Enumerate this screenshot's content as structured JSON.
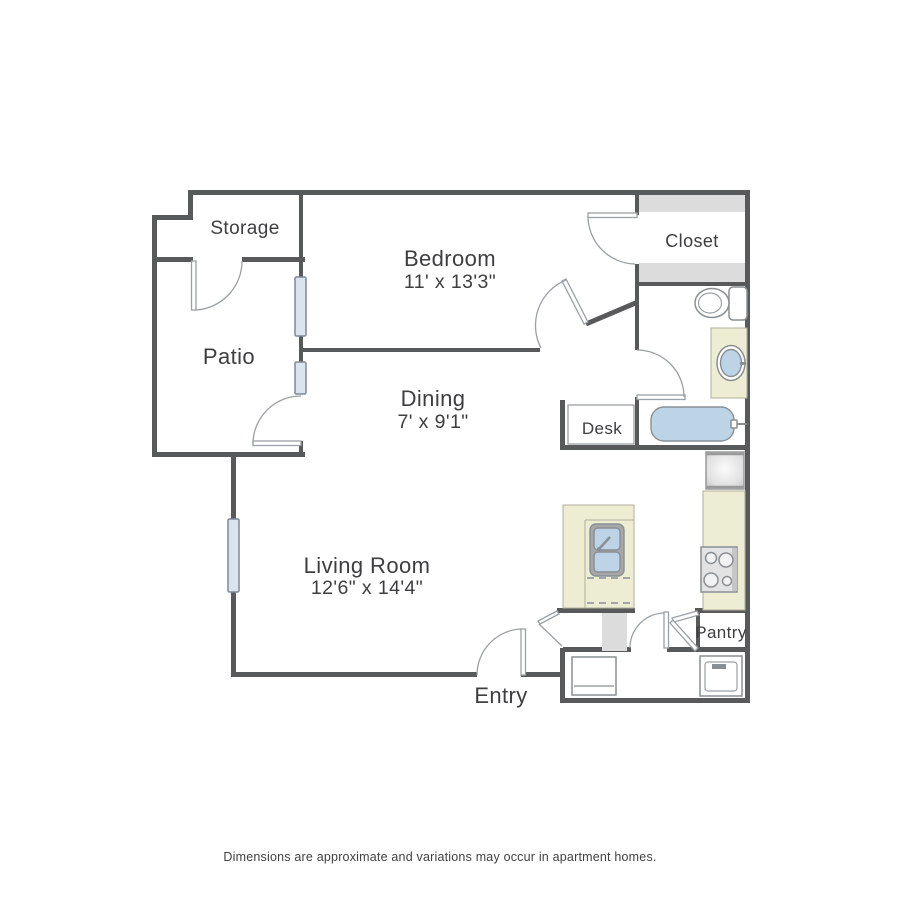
{
  "caption": "Dimensions are approximate and variations may occur in apartment homes.",
  "rooms": {
    "storage": {
      "label": "Storage"
    },
    "bedroom": {
      "label": "Bedroom",
      "dimensions": "11' x 13'3\""
    },
    "closet": {
      "label": "Closet"
    },
    "patio": {
      "label": "Patio"
    },
    "dining": {
      "label": "Dining",
      "dimensions": "7' x 9'1\""
    },
    "living_room": {
      "label": "Living Room",
      "dimensions": "12'6\" x 14'4\""
    },
    "desk": {
      "label": "Desk"
    },
    "pantry": {
      "label": "Pantry"
    },
    "entry": {
      "label": "Entry"
    }
  },
  "fixtures": [
    "toilet",
    "bathroom-sink",
    "bathtub",
    "kitchen-sink",
    "stove",
    "refrigerator",
    "washer",
    "dryer",
    "desk",
    "closet-shelves",
    "windows",
    "doors"
  ],
  "colors": {
    "wall": "#58595b",
    "window_fill": "#d9e4ef",
    "counter_fill": "#ededd3",
    "shelf_fill": "#dcdcdc",
    "plumbing_blue": "#bdd3e6",
    "door_line": "#9aa0a5",
    "label_text": "#3e3e40"
  }
}
